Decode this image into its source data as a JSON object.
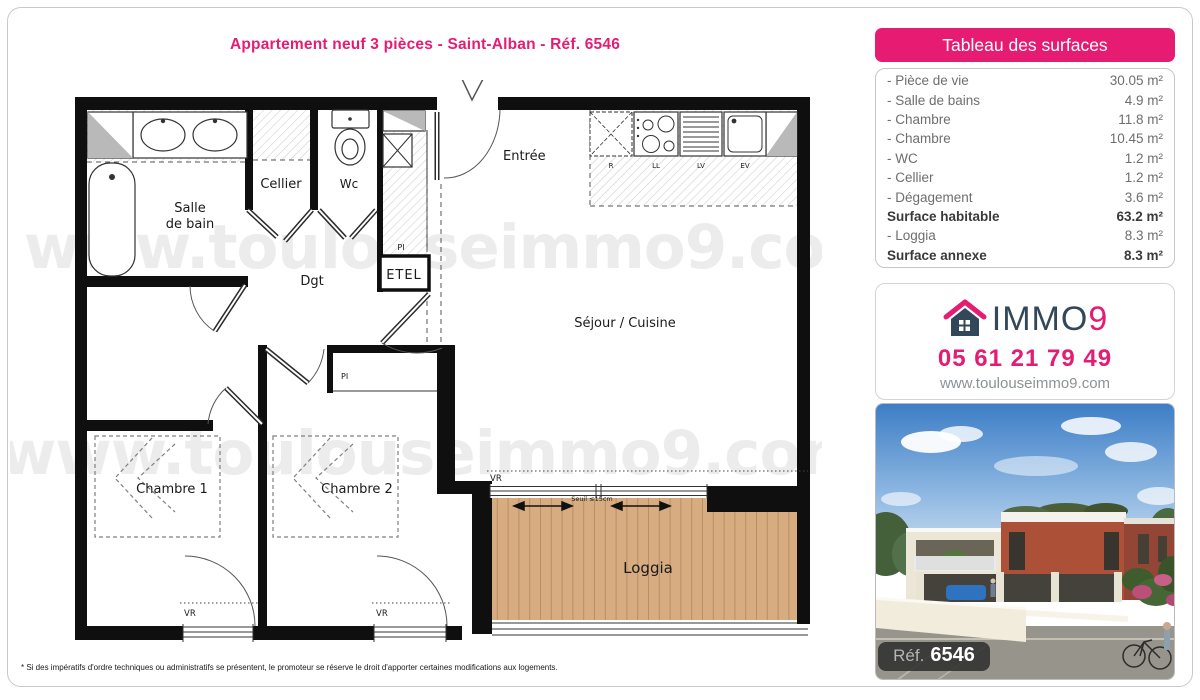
{
  "title": "Appartement neuf 3 pièces - Saint-Alban - Réf. 6546",
  "surfaces_panel": {
    "header": "Tableau des surfaces",
    "rows": [
      {
        "label": "- Pièce de vie",
        "value": "30.05 m²",
        "bold": false
      },
      {
        "label": "- Salle de bains",
        "value": "4.9 m²",
        "bold": false
      },
      {
        "label": "- Chambre",
        "value": "11.8 m²",
        "bold": false
      },
      {
        "label": "- Chambre",
        "value": "10.45 m²",
        "bold": false
      },
      {
        "label": "- WC",
        "value": "1.2 m²",
        "bold": false
      },
      {
        "label": "- Cellier",
        "value": "1.2 m²",
        "bold": false
      },
      {
        "label": "- Dégagement",
        "value": "3.6 m²",
        "bold": false
      },
      {
        "label": "Surface habitable",
        "value": "63.2 m²",
        "bold": true
      },
      {
        "label": "- Loggia",
        "value": "8.3 m²",
        "bold": false
      },
      {
        "label": "Surface annexe",
        "value": "8.3 m²",
        "bold": true
      }
    ]
  },
  "agency": {
    "brand_word": "IMMO",
    "brand_digit": "9",
    "house_icon": "immo9-house-icon",
    "phone": "05 61 21 79 49",
    "website": "www.toulouseimmo9.com"
  },
  "photo": {
    "ref_word": "Réf.",
    "ref_number": "6546"
  },
  "plan": {
    "watermark": "www.toulouseimmo9.com",
    "rooms": {
      "salle_de_bain": [
        "Salle",
        "de bain"
      ],
      "cellier": "Cellier",
      "wc": "Wc",
      "entree": "Entrée",
      "dgt": "Dgt",
      "sejour": "Séjour / Cuisine",
      "chambre1": "Chambre 1",
      "chambre2": "Chambre 2",
      "loggia": "Loggia"
    },
    "tags": {
      "etel": "ETEL",
      "pi": "PI",
      "vr": "VR",
      "seuil": "Seuil ≤15cm",
      "kitchen": {
        "r": "R",
        "ll": "LL",
        "lv": "LV",
        "ev": "EV"
      }
    }
  },
  "footer": "* Si des impératifs d'ordre techniques ou administratifs se présentent, le promoteur se réserve le droit d'apporter certaines modifications aux logements.",
  "colors": {
    "brand_pink": "#e61b72",
    "brand_navy": "#33475a",
    "watermark_gray": "#ececec"
  }
}
